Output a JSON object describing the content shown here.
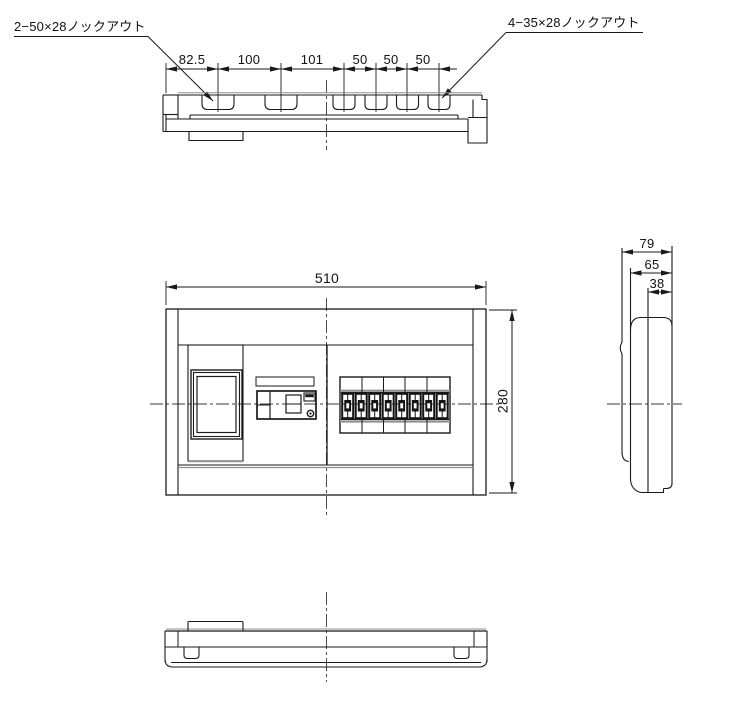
{
  "drawing": {
    "title_note": "",
    "top_view": {
      "knockout_label_left": "2−50×28ノックアウト",
      "knockout_label_right": "4−35×28ノックアウト",
      "dim_chain": [
        "82.5",
        "100",
        "101",
        "50",
        "50",
        "50"
      ]
    },
    "front_view": {
      "dim_width": "510",
      "dim_height": "280"
    },
    "side_view": {
      "dim_depth_total": "79",
      "dim_depth_mid": "65",
      "dim_depth_front": "38"
    },
    "colors": {
      "line": "#1a1a1a",
      "shadow": "#909090",
      "background": "#ffffff"
    }
  }
}
